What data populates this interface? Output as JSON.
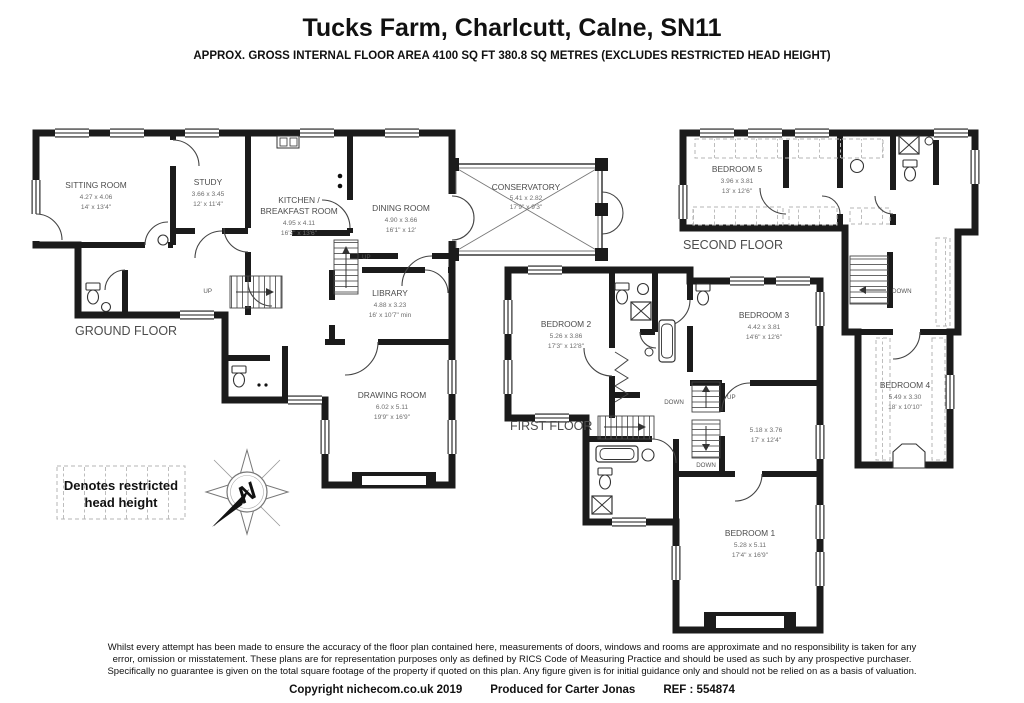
{
  "header": {
    "title": "Tucks Farm, Charlcutt, Calne, SN11",
    "subtitle": "APPROX. GROSS INTERNAL FLOOR AREA 4100 SQ FT 380.8 SQ METRES (EXCLUDES RESTRICTED HEAD HEIGHT)"
  },
  "floors": {
    "ground": {
      "label": "GROUND FLOOR",
      "rooms": {
        "sitting": {
          "name": "SITTING ROOM",
          "metric": "4.27 x 4.06",
          "imperial": "14' x 13'4\""
        },
        "study": {
          "name": "STUDY",
          "metric": "3.66 x 3.45",
          "imperial": "12' x 11'4\""
        },
        "kitchen": {
          "name1": "KITCHEN /",
          "name2": "BREAKFAST ROOM",
          "metric": "4.95 x 4.11",
          "imperial": "16'3\" x 13'6\""
        },
        "dining": {
          "name": "DINING ROOM",
          "metric": "4.90 x 3.66",
          "imperial": "16'1\" x 12'"
        },
        "conservatory": {
          "name": "CONSERVATORY",
          "metric": "5.41 x 2.82",
          "imperial": "17'9\" x 9'3\""
        },
        "library": {
          "name": "LIBRARY",
          "metric": "4.88 x 3.23",
          "imperial": "16' x 10'7\" min"
        },
        "drawing": {
          "name": "DRAWING ROOM",
          "metric": "6.02 x 5.11",
          "imperial": "19'9\" x 16'9\""
        }
      }
    },
    "first": {
      "label": "FIRST FLOOR",
      "rooms": {
        "bedroom2": {
          "name": "BEDROOM 2",
          "metric": "5.26 x 3.86",
          "imperial": "17'3\" x 12'8\""
        },
        "bedroom3": {
          "name": "BEDROOM 3",
          "metric": "4.42 x 3.81",
          "imperial": "14'6\" x 12'6\""
        },
        "landing": {
          "metric": "5.18 x 3.76",
          "imperial": "17' x 12'4\""
        },
        "bedroom1": {
          "name": "BEDROOM 1",
          "metric": "5.28 x 5.11",
          "imperial": "17'4\" x 16'9\""
        }
      }
    },
    "second": {
      "label": "SECOND FLOOR",
      "rooms": {
        "bedroom5": {
          "name": "BEDROOM 5",
          "metric": "3.96 x 3.81",
          "imperial": "13' x 12'6\""
        },
        "bedroom4": {
          "name": "BEDROOM 4",
          "metric": "5.49 x 3.30",
          "imperial": "18' x 10'10\""
        }
      }
    }
  },
  "stairs": {
    "up": "UP",
    "down": "DOWN"
  },
  "legend": {
    "line1": "Denotes restricted",
    "line2": "head height"
  },
  "compass": {
    "north": "N"
  },
  "footer": {
    "disclaimer_line1": "Whilst every attempt has been made to ensure the accuracy of the floor plan contained here, measurements of doors, windows and rooms are approximate and no responsibility is taken for any",
    "disclaimer_line2": "error, omission or misstatement. These plans are for representation purposes only as defined by RICS Code of Measuring Practice and should be used as such by any prospective purchaser.",
    "disclaimer_line3": "Specifically no guarantee is given on the total square footage of the property if quoted on this plan. Any figure given is for initial guidance only and should not be relied on as a basis of valuation.",
    "copyright": "Copyright nichecom.co.uk 2019",
    "produced": "Produced for Carter Jonas",
    "ref": "REF : 554874"
  },
  "colors": {
    "wall": "#1b1b1b",
    "room_text": "#4c4c4c",
    "dim_text": "#6e6e6e"
  }
}
